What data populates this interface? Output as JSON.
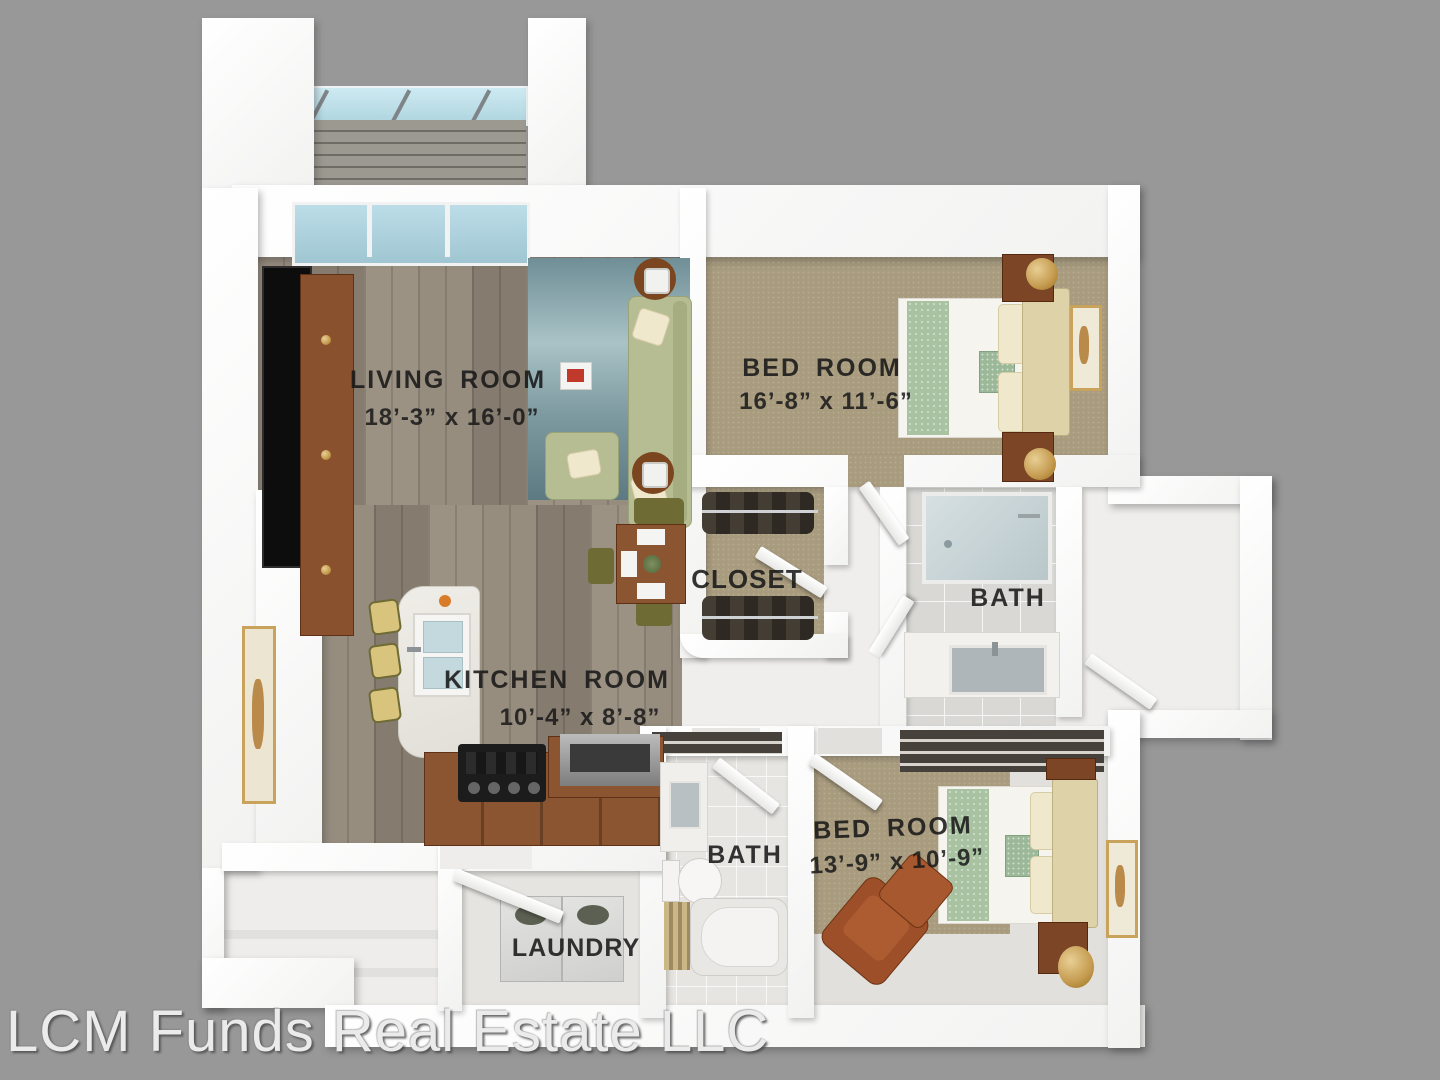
{
  "watermark": "LCM Funds Real Estate LLC",
  "rooms": {
    "living": {
      "name": "LIVING ROOM",
      "dims": "18’-3” x 16’-0”"
    },
    "bedroom1": {
      "name": "BED ROOM",
      "dims": "16’-8” x 11’-6”"
    },
    "closet": {
      "name": "CLOSET"
    },
    "bath1": {
      "name": "BATH"
    },
    "kitchen": {
      "name": "KITCHEN  ROOM",
      "dims": "10’-4” x 8’-8”"
    },
    "bath2": {
      "name": "BATH"
    },
    "bedroom2": {
      "name": "BED ROOM",
      "dims": "13’-9” x 10’-9”"
    },
    "laundry": {
      "name": "LAUNDRY"
    }
  },
  "colors": {
    "background": "#989898",
    "wall": "#fafafa",
    "wood_floor": "#8f8578",
    "carpet": "#a89b7e",
    "tile": "#d9d8d4",
    "rug": "#7fa3ab",
    "sofa": "#b7bd93",
    "cabinet_wood": "#8a5530",
    "watermark_text": "#ebebeb"
  }
}
